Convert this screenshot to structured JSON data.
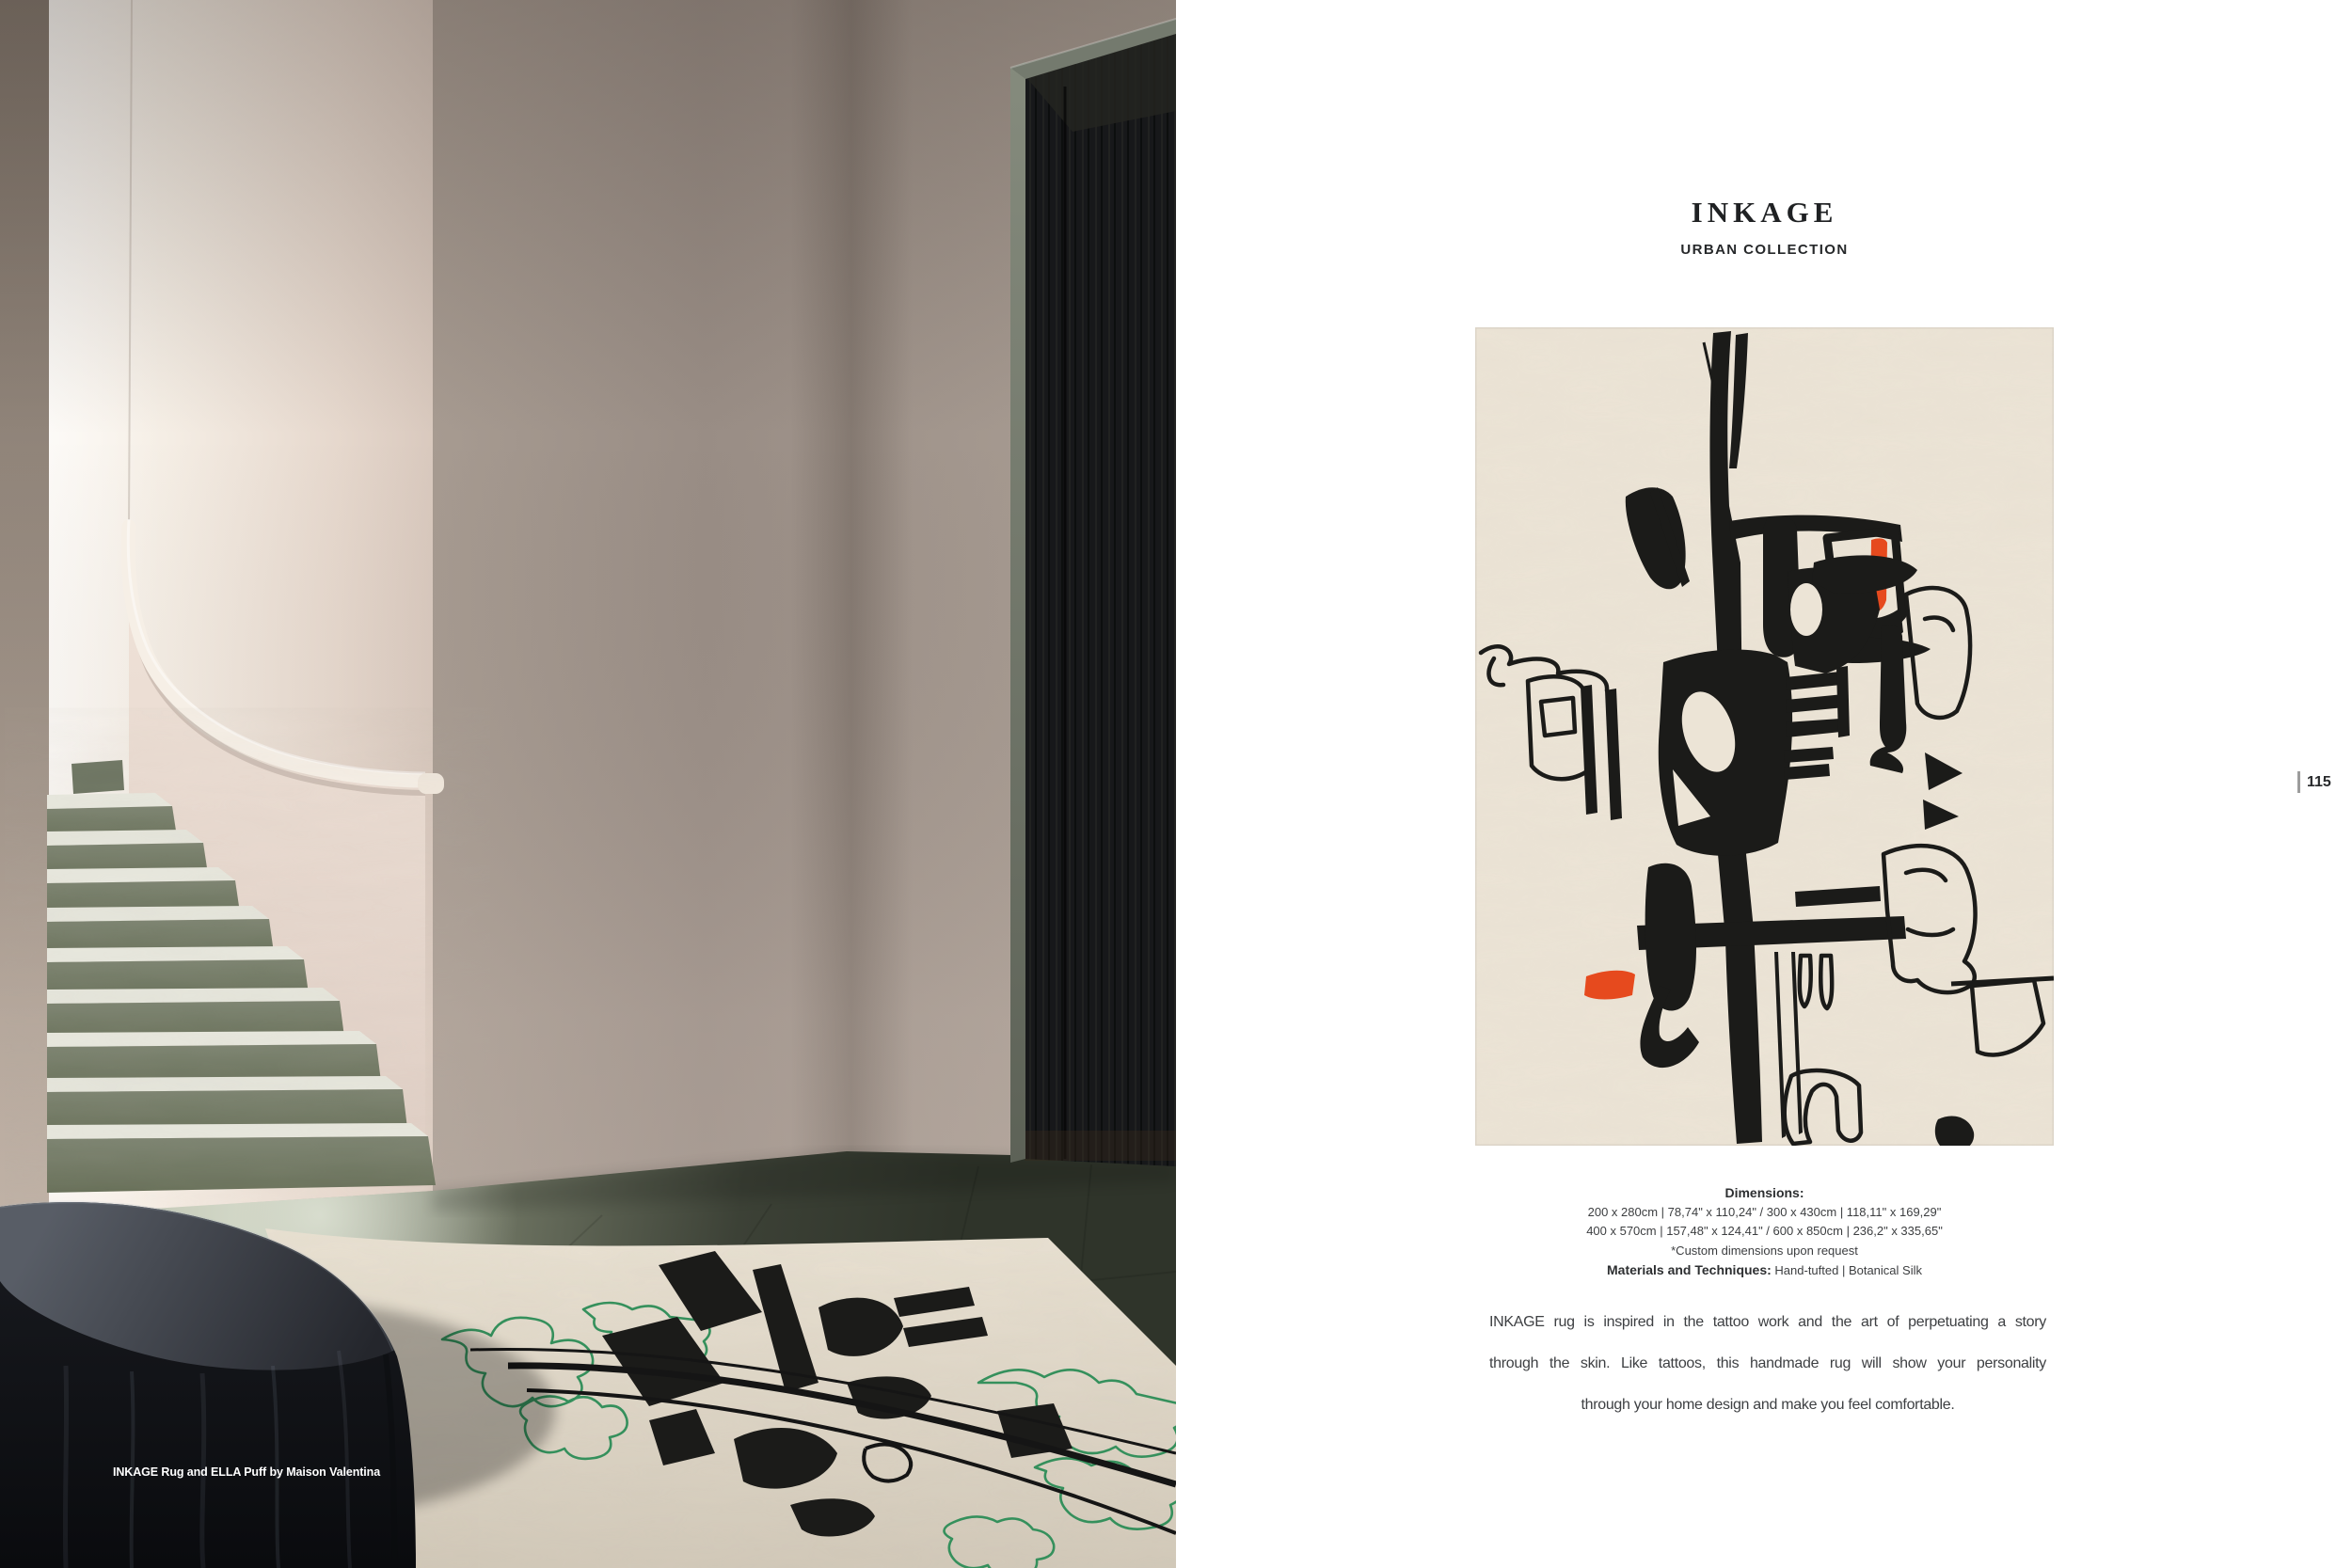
{
  "photo": {
    "caption": "INKAGE Rug and ELLA Puff by Maison Valentina"
  },
  "product": {
    "title": "INKAGE",
    "collection": "URBAN COLLECTION",
    "dimensions_label": "Dimensions:",
    "dimensions_lines": [
      "200 x 280cm | 78,74\" x 110,24\" / 300 x 430cm | 118,11\" x 169,29\"",
      "400 x 570cm | 157,48\" x 124,41\" / 600 x 850cm | 236,2\" x 335,65\""
    ],
    "custom_note": "*Custom dimensions upon request",
    "materials_label": "Materials and Techniques:",
    "materials_value": "Hand-tufted | Botanical Silk",
    "description_lines": [
      "INKAGE rug is inspired in the tattoo work and the art of perpetuating a story",
      "through the skin. Like tattoos, this handmade rug will show your personality",
      "through your home design and make you feel comfortable."
    ],
    "page_number": "115"
  },
  "colors": {
    "page_background": "#ffffff",
    "rug_base": "#ece4d6",
    "ink": "#1b1b19",
    "accent_orange": "#e64a1e",
    "accent_green": "#35905c",
    "stone_green": "#78806c",
    "floor_dark": "#363b2f",
    "wall_taupe": "#a2968c",
    "text_dark": "#3f4143"
  }
}
